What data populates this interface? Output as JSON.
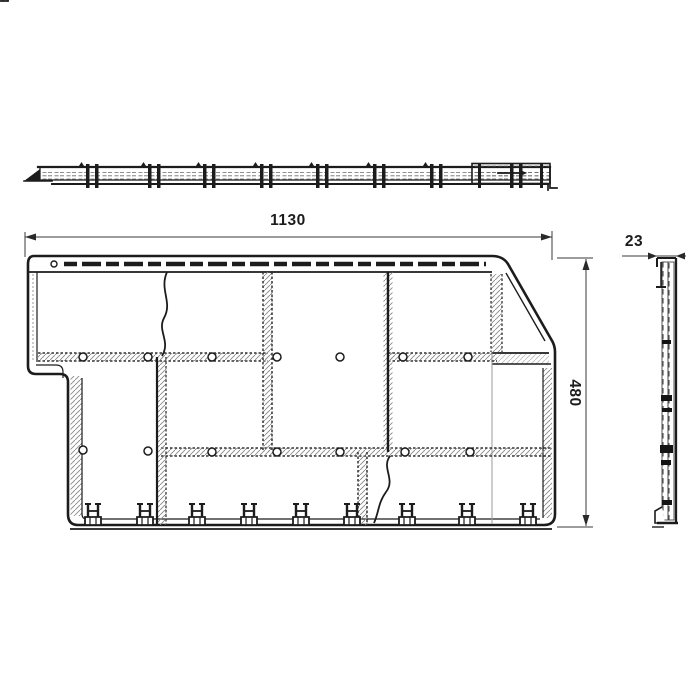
{
  "drawing": {
    "kind": "facade-panel-technical-drawing",
    "dims": {
      "width": "1130",
      "height": "480",
      "depth": "23"
    },
    "colors": {
      "line": "#1c1c1c",
      "dim_line": "#3a3a3a",
      "hatch": "#777777",
      "background": "#ffffff"
    }
  }
}
